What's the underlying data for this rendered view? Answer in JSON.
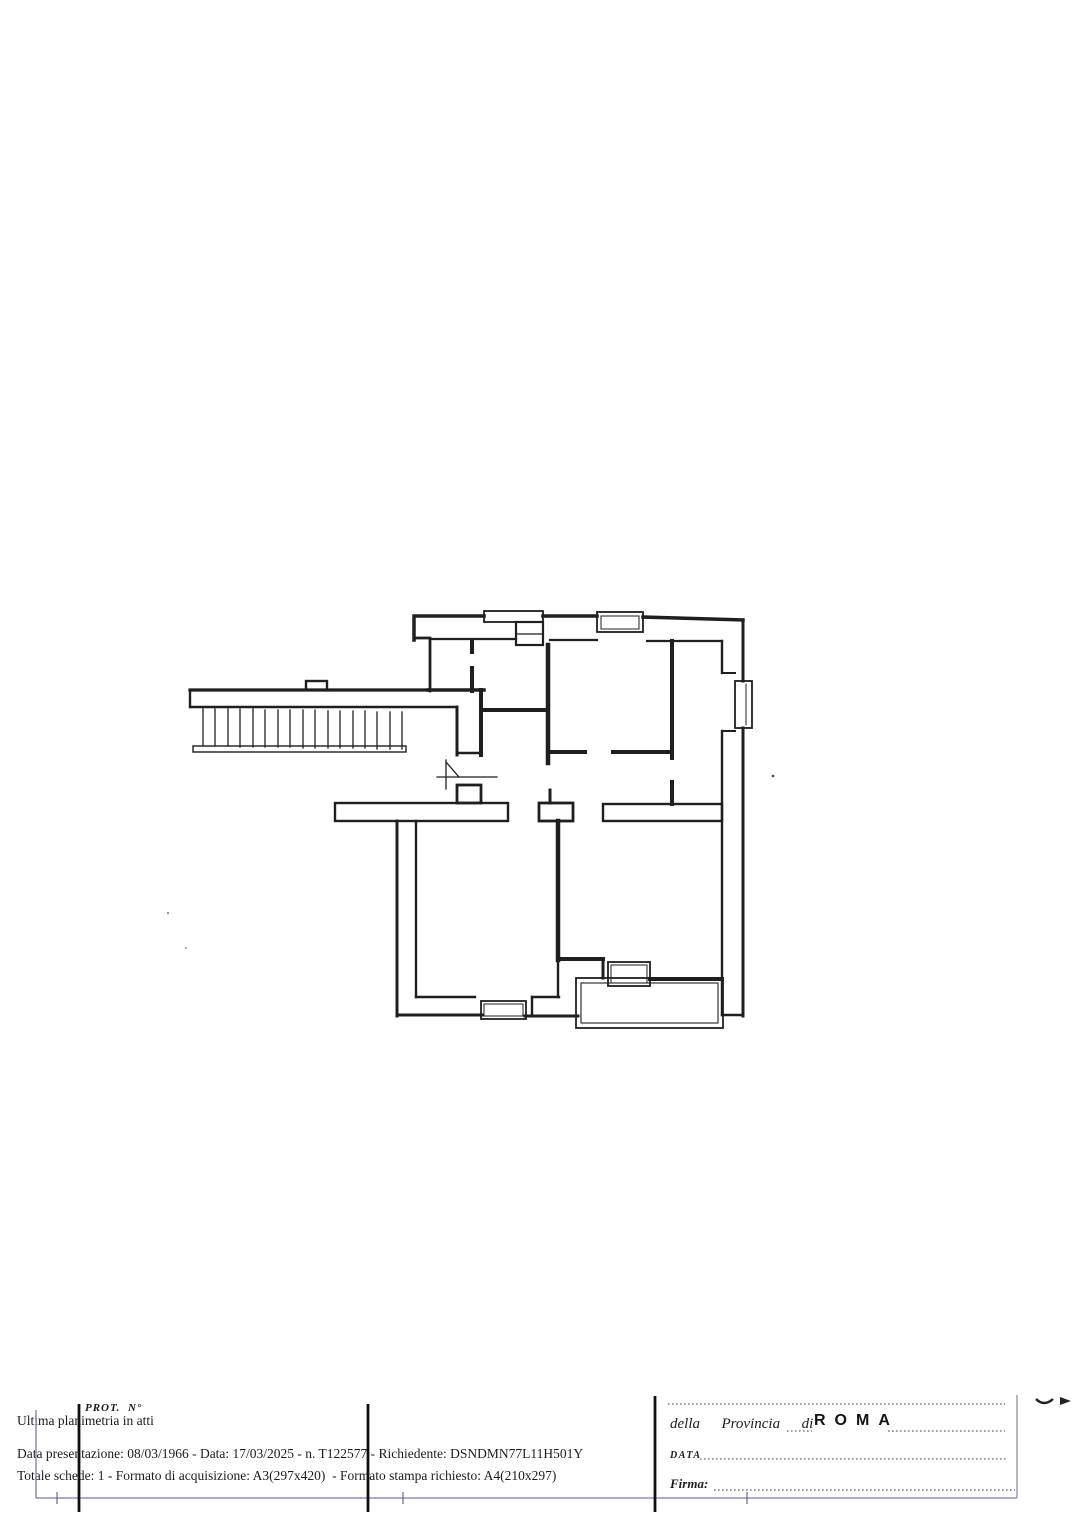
{
  "footer": {
    "prot_label": "PROT.  N°",
    "ultima": "Ultima planimetria in atti",
    "dettagli": "Data presentazione: 08/03/1966 - Data: 17/03/2025 - n. T122577 - Richiedente: DSNDMN77L11H501Y",
    "formati": "Totale schede: 1 - Formato di acquisizione: A3(297x420)  - Formato stampa richiesto: A4(210x297)"
  },
  "stamp_form": {
    "provincia_label": "della  Provincia  di",
    "provincia_value": "ROMA",
    "data_label": "DATA",
    "firma_label": "Firma:"
  },
  "floor_plan": {
    "features": [
      "external-staircase-with-railing",
      "entrance-door-swing",
      "top-window-left",
      "top-window-center",
      "right-bay-window",
      "bottom-window",
      "terrace-with-window"
    ]
  },
  "colors": {
    "paper": "#ffffff",
    "ink": "#1f1f1f",
    "margin_blue": "#7b7bb0"
  }
}
